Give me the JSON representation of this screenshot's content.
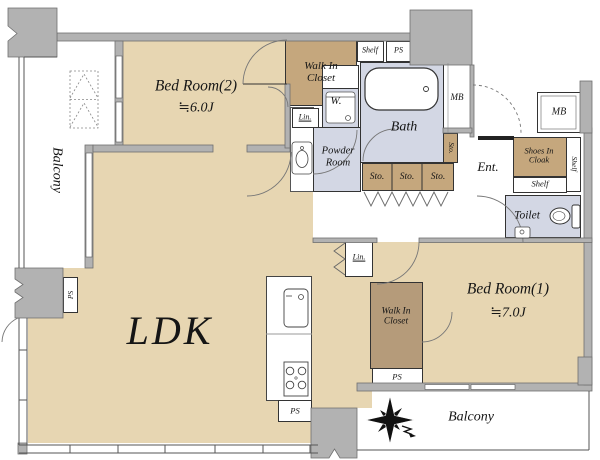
{
  "rooms": {
    "ldk": {
      "label": "LDK"
    },
    "bedroom2": {
      "label": "Bed Room(2)",
      "size": "≒6.0J"
    },
    "bedroom1": {
      "label": "Bed Room(1)",
      "size": "≒7.0J"
    },
    "balcony_left": {
      "label": "Balcony"
    },
    "balcony_bottom": {
      "label": "Balcony"
    },
    "walk_in_closet_top": {
      "label": "Walk In Closet"
    },
    "walk_in_closet_bedroom1": {
      "label": "Walk In Closet"
    },
    "bath": {
      "label": "Bath"
    },
    "powder_room": {
      "label": "Powder Room"
    },
    "toilet": {
      "label": "Toilet"
    },
    "entrance": {
      "label": "Ent."
    },
    "shoes_in_cloak": {
      "label": "Shoes In Cloak"
    }
  },
  "labels": {
    "shelf": "Shelf",
    "ps": "PS",
    "mb": "MB",
    "sto": "Sto.",
    "lin": "Lin.",
    "washer": "W."
  },
  "colors": {
    "floor_tan": "#e7d6b2",
    "closet_brown": "#c5a77d",
    "wet_area_blue": "#d3d7e4",
    "wall_gray": "#b2b2b2",
    "outline": "#333333"
  }
}
